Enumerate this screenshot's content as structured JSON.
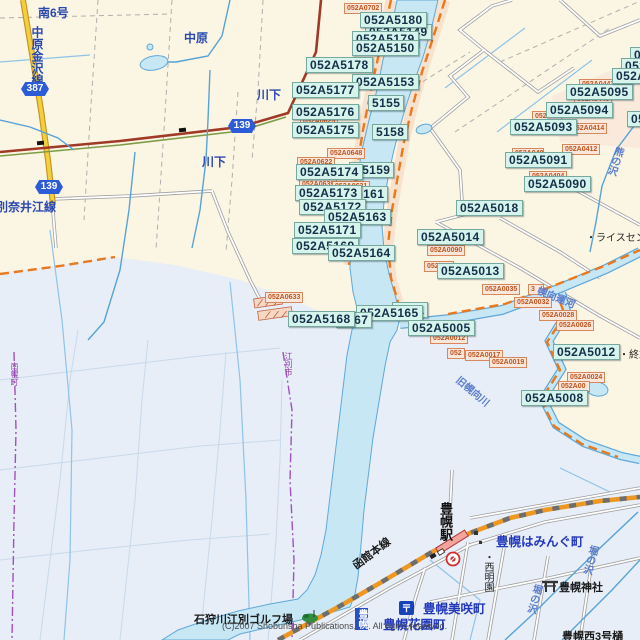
{
  "meta": {
    "copyright": "(C)2007 Shobunsha Publications,Inc. All rights reserved.",
    "post_mark": "〒"
  },
  "shields": [
    {
      "num": "387",
      "x": 21,
      "y": 82
    },
    {
      "num": "139",
      "x": 35,
      "y": 180
    },
    {
      "num": "139",
      "x": 228,
      "y": 119
    }
  ],
  "code_labels": {
    "cyan": [
      {
        "text": "052A5149",
        "x": 365,
        "y": 24
      },
      {
        "text": "052A5180",
        "x": 360,
        "y": 12
      },
      {
        "text": "052A5179",
        "x": 352,
        "y": 31
      },
      {
        "text": "052A5150",
        "x": 352,
        "y": 40
      },
      {
        "text": "052A5178",
        "x": 306,
        "y": 57
      },
      {
        "text": "052A5153",
        "x": 352,
        "y": 74
      },
      {
        "text": "5155",
        "x": 368,
        "y": 95
      },
      {
        "text": "052A5177",
        "x": 292,
        "y": 82
      },
      {
        "text": "052A5176",
        "x": 292,
        "y": 104
      },
      {
        "text": "5158",
        "x": 372,
        "y": 124
      },
      {
        "text": "052A5175",
        "x": 292,
        "y": 122
      },
      {
        "text": "A5159",
        "x": 349,
        "y": 162
      },
      {
        "text": "052A5174",
        "x": 296,
        "y": 164
      },
      {
        "text": "5161",
        "x": 352,
        "y": 186
      },
      {
        "text": "052A5173",
        "x": 295,
        "y": 185
      },
      {
        "text": "052A5172",
        "x": 299,
        "y": 199
      },
      {
        "text": "052A5163",
        "x": 324,
        "y": 209
      },
      {
        "text": "052A5171",
        "x": 294,
        "y": 222
      },
      {
        "text": "052A5169",
        "x": 292,
        "y": 238
      },
      {
        "text": "052A5164",
        "x": 328,
        "y": 245
      },
      {
        "text": "5001",
        "x": 392,
        "y": 302
      },
      {
        "text": "052A5165",
        "x": 356,
        "y": 305
      },
      {
        "text": "5167",
        "x": 336,
        "y": 312
      },
      {
        "text": "052A5168",
        "x": 288,
        "y": 311
      },
      {
        "text": "052A5005",
        "x": 408,
        "y": 320
      },
      {
        "text": "052A5095",
        "x": 566,
        "y": 84
      },
      {
        "text": "052A5094",
        "x": 546,
        "y": 102
      },
      {
        "text": "052A5093",
        "x": 510,
        "y": 119
      },
      {
        "text": "052A5091",
        "x": 505,
        "y": 152
      },
      {
        "text": "052A5090",
        "x": 524,
        "y": 176
      },
      {
        "text": "052A5018",
        "x": 456,
        "y": 200
      },
      {
        "text": "052A5014",
        "x": 417,
        "y": 229
      },
      {
        "text": "052A5013",
        "x": 437,
        "y": 263
      },
      {
        "text": "052A5012",
        "x": 553,
        "y": 344
      },
      {
        "text": "052A5008",
        "x": 521,
        "y": 390
      },
      {
        "text": "052A50",
        "x": 630,
        "y": 47
      },
      {
        "text": "052A50",
        "x": 621,
        "y": 58
      },
      {
        "text": "052A509",
        "x": 612,
        "y": 68
      },
      {
        "text": "052A50",
        "x": 627,
        "y": 111
      }
    ],
    "orange": [
      {
        "text": "052A0702",
        "x": 344,
        "y": 3
      },
      {
        "text": "052A0625",
        "x": 300,
        "y": 116
      },
      {
        "text": "052A0648",
        "x": 327,
        "y": 148
      },
      {
        "text": "052A0622",
        "x": 297,
        "y": 157
      },
      {
        "text": "052A0639",
        "x": 299,
        "y": 179
      },
      {
        "text": "052A0631",
        "x": 332,
        "y": 181
      },
      {
        "text": "052A0633",
        "x": 265,
        "y": 292
      },
      {
        "text": "052A0035",
        "x": 482,
        "y": 284
      },
      {
        "text": "3",
        "x": 528,
        "y": 284,
        "w": 10
      },
      {
        "text": "052A0032",
        "x": 514,
        "y": 297
      },
      {
        "text": "052A0028",
        "x": 539,
        "y": 310
      },
      {
        "text": "052A0026",
        "x": 556,
        "y": 320
      },
      {
        "text": "052A0012",
        "x": 430,
        "y": 333
      },
      {
        "text": "052",
        "x": 447,
        "y": 348
      },
      {
        "text": "052A0017",
        "x": 465,
        "y": 350
      },
      {
        "text": "052A0019",
        "x": 489,
        "y": 357
      },
      {
        "text": "052A0443",
        "x": 579,
        "y": 79
      },
      {
        "text": "052A0440",
        "x": 574,
        "y": 94
      },
      {
        "text": "052A04",
        "x": 532,
        "y": 111,
        "w": 24
      },
      {
        "text": "052A0414",
        "x": 569,
        "y": 123
      },
      {
        "text": "052A0412",
        "x": 562,
        "y": 144
      },
      {
        "text": "052A040",
        "x": 512,
        "y": 148,
        "w": 26
      },
      {
        "text": "052A0404",
        "x": 529,
        "y": 171
      },
      {
        "text": "052A0090",
        "x": 427,
        "y": 245
      },
      {
        "text": "052A00",
        "x": 424,
        "y": 261,
        "w": 24
      },
      {
        "text": "052A0024",
        "x": 567,
        "y": 372
      },
      {
        "text": "052A00",
        "x": 558,
        "y": 381,
        "w": 26
      }
    ]
  },
  "map_labels": [
    {
      "text": "南6号",
      "x": 38,
      "y": 4,
      "cls": "blue"
    },
    {
      "text": "中原金沢線",
      "x": 29,
      "y": 26,
      "cls": "blue",
      "vertical": true
    },
    {
      "text": "中原",
      "x": 184,
      "y": 29,
      "cls": "blue"
    },
    {
      "text": "川下",
      "x": 257,
      "y": 86,
      "cls": "blue"
    },
    {
      "text": "川下",
      "x": 202,
      "y": 153,
      "cls": "blue"
    },
    {
      "text": "別奈井江線",
      "x": -4,
      "y": 198,
      "cls": "blue"
    },
    {
      "text": "・ライスセンタ",
      "x": 586,
      "y": 229,
      "cls": "black-sm"
    },
    {
      "text": "・終末",
      "x": 619,
      "y": 346,
      "cls": "black-sm"
    },
    {
      "text": "旧幌向川",
      "x": 463,
      "y": 372,
      "cls": "stream",
      "rotate": 40
    },
    {
      "text": "幌向運河",
      "x": 541,
      "y": 282,
      "cls": "stream",
      "rotate": 22
    },
    {
      "text": "熊の沢",
      "x": 612,
      "y": 144,
      "cls": "stream",
      "vertical": true,
      "rotate": 18
    },
    {
      "text": "堀の沢",
      "x": 586,
      "y": 543,
      "cls": "stream",
      "vertical": true,
      "rotate": 15
    },
    {
      "text": "堀の沢",
      "x": 530,
      "y": 582,
      "cls": "stream",
      "vertical": true,
      "rotate": 15
    },
    {
      "text": "豊幌はみんぐ町",
      "x": 496,
      "y": 531,
      "cls": "town"
    },
    {
      "text": "豊幌美咲町",
      "x": 423,
      "y": 598,
      "cls": "town"
    },
    {
      "text": "豊幌花園町",
      "x": 383,
      "y": 614,
      "cls": "town"
    },
    {
      "text": "豊幌神社",
      "x": 559,
      "y": 579,
      "cls": "black"
    },
    {
      "text": "豊幌西3号樋",
      "x": 562,
      "y": 628,
      "cls": "black"
    },
    {
      "text": "豊幌駅",
      "x": 436,
      "y": 502,
      "cls": "black-bold",
      "vertical": true
    },
    {
      "text": "函館本線",
      "x": 349,
      "y": 560,
      "cls": "black",
      "rotate": -37
    },
    {
      "text": "・西明園",
      "x": 480,
      "y": 552,
      "cls": "black-sm",
      "vertical": true
    },
    {
      "text": "石狩川江別ゴルフ場",
      "x": 194,
      "y": 611,
      "cls": "black"
    },
    {
      "text": "(C)2007 Shobunsha Publications,Inc. All rights reserved.",
      "x": 222,
      "y": 621,
      "cls": "gray-sm"
    },
    {
      "text": "南幌町",
      "x": 9,
      "y": 362,
      "cls": "purple",
      "vertical": true
    },
    {
      "text": "江別市",
      "x": 283,
      "y": 352,
      "cls": "purple",
      "vertical": true
    },
    {
      "text": "豊幌",
      "x": 355,
      "y": 608,
      "cls": "badge",
      "vertical": true
    }
  ]
}
